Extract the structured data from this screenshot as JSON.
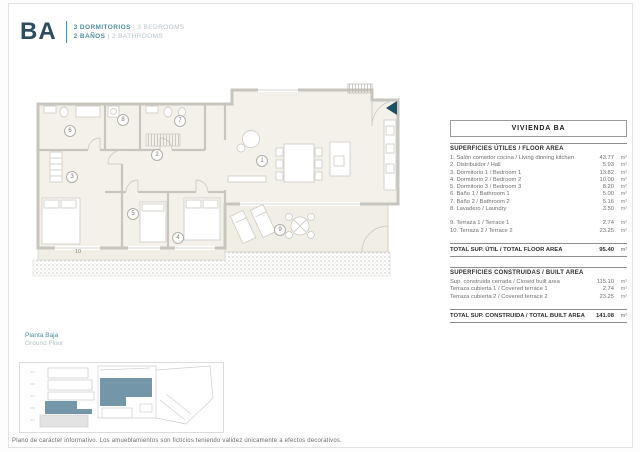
{
  "header": {
    "unit_code": "BA",
    "bedrooms_es": "3 DORMITORIOS",
    "separator": "|",
    "bedrooms_en": "3 BEDROOMS",
    "bathrooms_es": "2 BAÑOS",
    "bathrooms_en": "2 BATHROOMS"
  },
  "plan": {
    "rooms": [
      "1",
      "2",
      "3",
      "4",
      "5",
      "6",
      "7",
      "8",
      "9",
      "10"
    ]
  },
  "table": {
    "title": "VIVIENDA BA",
    "unit": "m²",
    "floor_section": {
      "heading": "SUPERFICIES ÚTILES / FLOOR AREA",
      "rows": [
        {
          "label": "1. Salón comedor cocina / Living dinning kitchen",
          "value": "43.77"
        },
        {
          "label": "2. Distribuidor / Hall",
          "value": "5.93"
        },
        {
          "label": "3. Dormitorio 1 / Bedroom 1",
          "value": "13.82"
        },
        {
          "label": "4. Dormitorio 2 / Bedroom 2",
          "value": "10.00"
        },
        {
          "label": "5. Dormitorio 3 / Bedroom 3",
          "value": "8.20"
        },
        {
          "label": "6. Baño 1 / Bathroom 1",
          "value": "5.00"
        },
        {
          "label": "7. Baño 2 / Bathroom 2",
          "value": "5.16"
        },
        {
          "label": "8. Lavadero / Laundry",
          "value": "3.50"
        }
      ],
      "terrace_rows": [
        {
          "label": "9. Terraza 1 / Terrace 1",
          "value": "2.74"
        },
        {
          "label": "10. Terraza 2 / Terrace 2",
          "value": "23.25"
        }
      ],
      "total": {
        "label": "TOTAL SUP. ÚTIL / TOTAL FLOOR AREA",
        "value": "95.40"
      }
    },
    "built_section": {
      "heading": "SUPERFICIES CONSTRUIDAS / BUILT AREA",
      "rows": [
        {
          "label": "Sup. construida cerrada / Closed built area",
          "value": "115.10"
        },
        {
          "label": "Terraza cubierta 1 / Covered terrace 1",
          "value": "2.74"
        },
        {
          "label": "Terraza cubierta 2 / Covered terrace 2",
          "value": "23.25"
        }
      ],
      "total": {
        "label": "TOTAL SUP. CONSTRUIDA / TOTAL BUILT AREA",
        "value": "141.08"
      }
    }
  },
  "floor_label": {
    "es": "Planta Baja",
    "en": "Ground Floor"
  },
  "footer": {
    "disclaimer": "Plano de carácter informativo. Los amueblamientos son ficticios teniendo validez únicamente a efectos decorativos."
  },
  "colors": {
    "accent_teal": "#4d8fa0",
    "dark_navy": "#2e4d5e",
    "thumb_highlight": "#7397a9",
    "entrance_arrow": "#1e4f62"
  }
}
